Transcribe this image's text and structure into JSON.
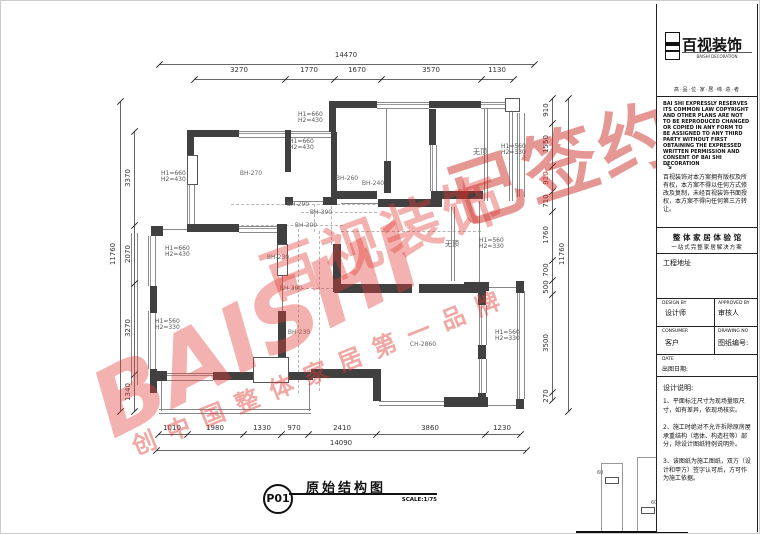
{
  "plan": {
    "dims": {
      "top": {
        "overall": "14470",
        "segments": [
          "3270",
          "1770",
          "1670",
          "3570",
          "1130"
        ]
      },
      "bottom": {
        "overall": "14090",
        "segments": [
          "1010",
          "1980",
          "1330",
          "970",
          "2410",
          "3860",
          "1230"
        ]
      },
      "left": {
        "overall": "11760",
        "segments": [
          "3370",
          "2070",
          "3270",
          "1340"
        ]
      },
      "right": {
        "overall": "11760",
        "segments": [
          "910",
          "1550",
          "910",
          "710",
          "1760",
          "700",
          "500",
          "3500",
          "270"
        ]
      }
    },
    "window_labels": [
      {
        "line1": "H1=660",
        "line2": "H2=430"
      },
      {
        "line1": "H1=660",
        "line2": "H2=430"
      },
      {
        "line1": "H1=560",
        "line2": "H2=330"
      },
      {
        "line1": "H1=660",
        "line2": "H2=430"
      },
      {
        "line1": "H1=660",
        "line2": "H2=430"
      },
      {
        "line1": "H1=560",
        "line2": "H2=330"
      },
      {
        "line1": "H1=560",
        "line2": "H2=330"
      },
      {
        "line1": "H1=560",
        "line2": "H2=330"
      }
    ],
    "beam_labels": [
      "BH-270",
      "BH-260",
      "BH-240",
      "BH-290",
      "BH-390",
      "BH-300",
      "BH-230",
      "BH-300",
      "BH-230"
    ],
    "ceiling_label": "CH-2860",
    "no_ceiling_labels": [
      "无顶",
      "无顶"
    ],
    "detail_dims": [
      "60",
      "60"
    ]
  },
  "watermark": {
    "letters": "BAISHI",
    "brand": "百视装饰",
    "stamp": "已签约",
    "slogan": "创中国整体家居第一品牌",
    "color": "#e03e36"
  },
  "titleblock": {
    "logo": {
      "brand": "百视装饰",
      "brand_en": "BAISHI DECORATION",
      "tagline": "高·品·位·家·居·缔·造·者"
    },
    "legal_en": "BAI SHI EXPRESSLY RESERVES ITS COMMON LAW COPYRIGHT AND OTHER PLANS ARE NOT TO BE REPRODUCED CHANGED OR COPIED IN ANY FORM TO BE ASSIGNED TO ANY THIRD PARTY WITHOUT FIRST OBTAINING THE EXPRESSED WRITTEN PERMISSION AND CONSENT OF BAI SHI DECORATION",
    "legal_arrow": "↘",
    "legal_cn": "百视装饰对本方案拥有版权及所有权，本方案不得以任何方式修改及复制，未经百视装饰书面授权，本方案不得向任何第三方转让。",
    "slogan_line1": "整 体 家 居 体 验 馆",
    "slogan_line2": "一站式完整家居解决方案",
    "project_address_label": "工程地址",
    "design_by_en": "DESIGN BY",
    "design_by_cn": "设计师",
    "approved_by_en": "APPROVED BY",
    "approved_by_cn": "审核人",
    "consumer_en": "CONSUMER",
    "consumer_cn": "客户",
    "drawing_no_en": "DRAWING NO",
    "drawing_no_cn": "图纸编号:",
    "date_en": "DATE",
    "date_cn": "出图日期:",
    "notes_title": "设计说明:",
    "notes": [
      "1、平面标注尺寸为现场量取尺寸，如有差异，依现场核实。",
      "2、施工时绝对不允许拆除原房屋承重结构（墙体、构造柱等）部分，除设计图纸特例说明外。",
      "3、该图纸为施工图纸，双方（设计和甲方）签字认可后，方可作为施工依据。"
    ]
  },
  "footer": {
    "sheet_no": "P01",
    "drawing_title": "原始结构图",
    "scale": "SCALE:1/75"
  }
}
